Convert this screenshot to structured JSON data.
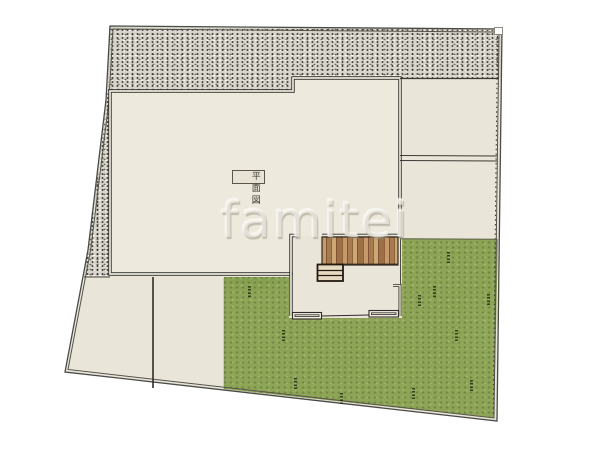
{
  "plan": {
    "label_text": "平面図",
    "watermark": "famitei"
  },
  "palette": {
    "paper_white": "#ffffff",
    "plot_fill": "#e9e5d8",
    "building_fill": "#ede9dc",
    "gravel_base": "#d8d4ca",
    "lawn_green": "#8ea557",
    "deck_wood_light": "#c49a6c",
    "deck_wood_dark": "#7d5533",
    "line_dark": "#2b2b28",
    "boundary_gray": "#4a4a46"
  }
}
